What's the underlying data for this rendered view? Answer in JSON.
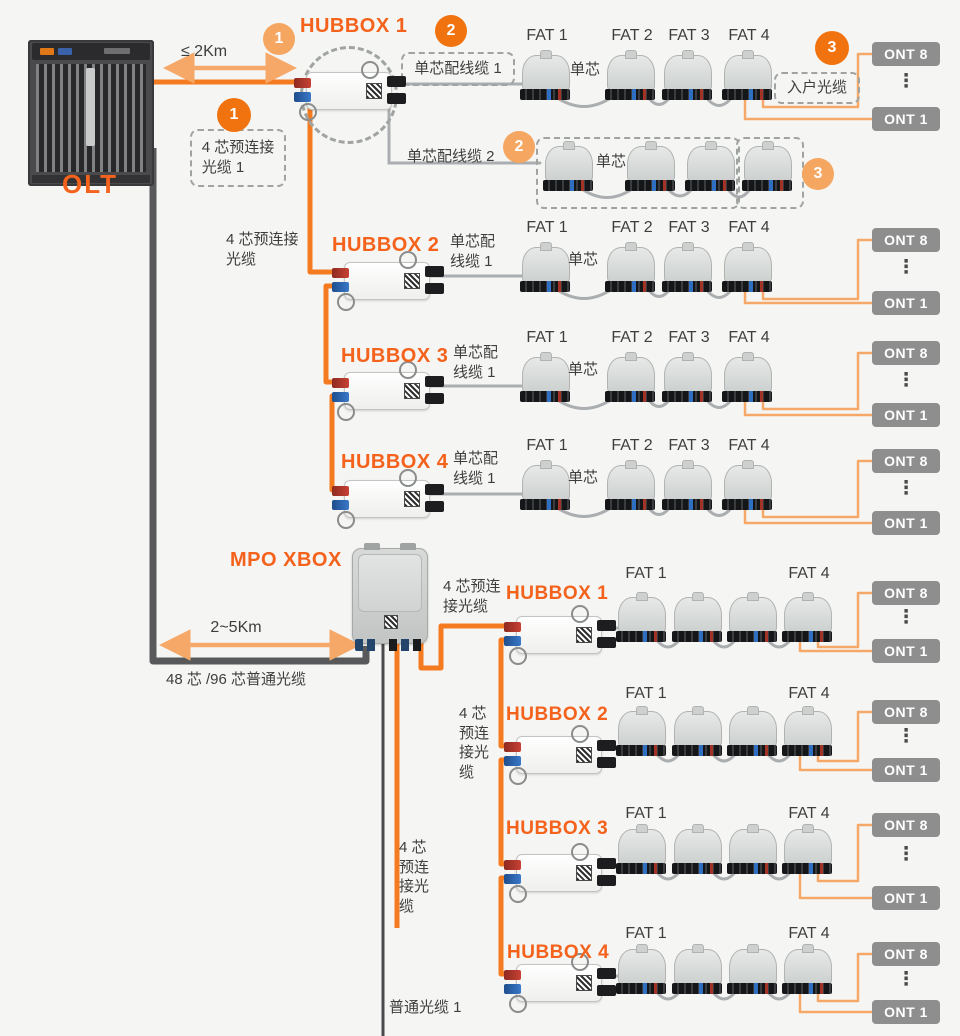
{
  "colors": {
    "background": "#F5F5F3",
    "accent_orange": "#F0730F",
    "light_orange": "#F5A761",
    "cable_orange": "#F47B20",
    "ont_line_orange": "#F5A868",
    "dark_cable": "#58595B",
    "thin_dark_cable": "#4A4A4C",
    "gray_cable": "#ABAEB0",
    "ont_gray": "#8E8E8E",
    "title_orange": "#F4621C",
    "text": "#3E3E3E"
  },
  "olt_label": "OLT",
  "mpo_label": "MPO XBOX",
  "distance_top": "≤ 2Km",
  "distance_bottom": "2~5Km",
  "badge1": "1",
  "badge2": "2",
  "badge3": "3",
  "cables": {
    "pre4_box": "4 芯预连接\n光缆 1",
    "pre4_two_line": "4 芯预连接\n光缆",
    "pre4_s1": "4 芯预连\n接光缆",
    "pre4_vertical": "4 芯\n预连\n接光\n缆",
    "drop1_box": "单芯配线缆 1",
    "drop2": "单芯配线缆 2",
    "drop_two_line": "单芯配\n线缆 1",
    "home_cable": "入户光缆",
    "single_core": "单芯",
    "trunk": "48 芯 /96 芯普通光缆",
    "ordinary": "普通光缆 1"
  },
  "top_group": {
    "hubbox1": "HUBBOX 1",
    "hubbox2": "HUBBOX 2",
    "hubbox3": "HUBBOX 3",
    "hubbox4": "HUBBOX 4",
    "fats": [
      "FAT 1",
      "FAT 2",
      "FAT 3",
      "FAT 4"
    ]
  },
  "bottom_group": {
    "hubbox1": "HUBBOX 1",
    "hubbox2": "HUBBOX 2",
    "hubbox3": "HUBBOX 3",
    "hubbox4": "HUBBOX 4",
    "fat_first": "FAT 1",
    "fat_last": "FAT 4"
  },
  "ont": {
    "top": "ONT 8",
    "bottom": "ONT 1",
    "dots": "⋮"
  }
}
